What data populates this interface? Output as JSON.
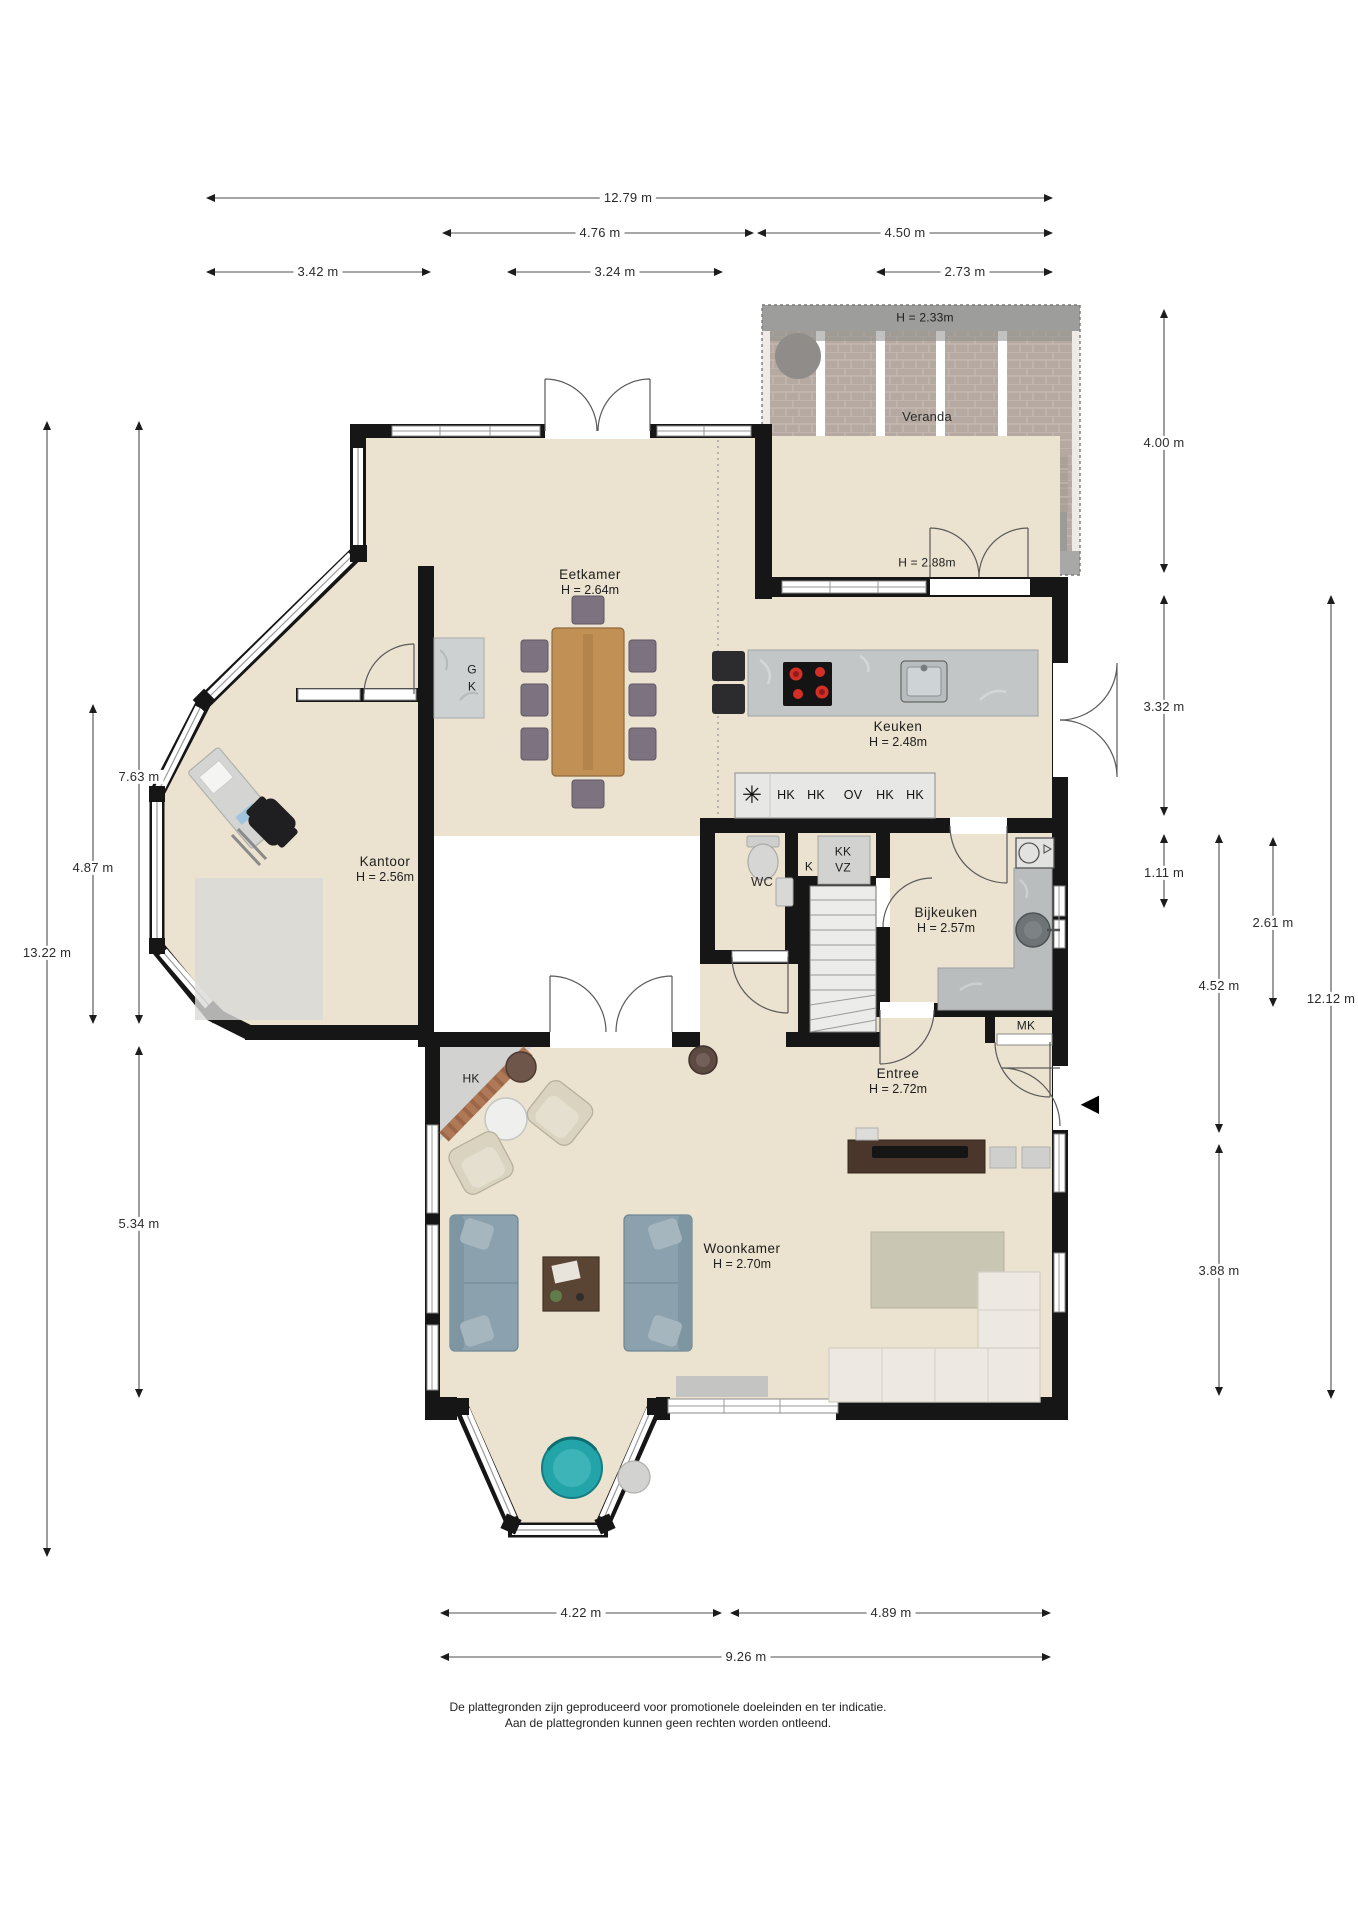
{
  "veranda": {
    "label": "Veranda",
    "height_top": "H = 2.33m",
    "height_bottom": "H = 2.88m"
  },
  "rooms": {
    "eetkamer": {
      "name": "Eetkamer",
      "height": "H = 2.64m"
    },
    "keuken": {
      "name": "Keuken",
      "height": "H = 2.48m"
    },
    "kantoor": {
      "name": "Kantoor",
      "height": "H = 2.56m"
    },
    "wc": {
      "name": "WC"
    },
    "bijkeuken": {
      "name": "Bijkeuken",
      "height": "H = 2.57m"
    },
    "entree": {
      "name": "Entree",
      "height": "H = 2.72m"
    },
    "woonkamer": {
      "name": "Woonkamer",
      "height": "H = 2.70m"
    }
  },
  "labels": {
    "g": "G",
    "k_fireplace": "K",
    "hk_corner": "HK",
    "k_closet": "K",
    "kk": "KK",
    "vz": "VZ",
    "mk": "MK"
  },
  "appliances": {
    "items": [
      "HK",
      "HK",
      "OV",
      "HK",
      "HK"
    ]
  },
  "icons": {
    "extractor_fan": "✳",
    "entrance_arrow": "◀"
  },
  "dimensions": {
    "top": [
      "12.79 m",
      "4.76 m",
      "4.50 m",
      "3.42 m",
      "3.24 m",
      "2.73 m"
    ],
    "left": [
      "13.22 m",
      "7.63 m",
      "4.87 m",
      "5.34 m"
    ],
    "right": [
      "4.00 m",
      "3.32 m",
      "1.11 m",
      "4.52 m",
      "3.88 m",
      "2.61 m",
      "12.12 m"
    ],
    "bottom": [
      "4.22 m",
      "4.89 m",
      "9.26 m"
    ]
  },
  "footer": {
    "line1": "De plattegronden zijn geproduceerd voor promotionele doeleinden en ter indicatie.",
    "line2": "Aan de plattegronden kunnen geen rechten worden ontleend."
  },
  "colors": {
    "floor": "#ebe2cf",
    "wall": "#161616",
    "counter_marble": "#c2c6c7",
    "burner_red": "#d32f27",
    "sofa_blue": "#8ba1ad",
    "chair_purple": "#7d7380",
    "wood_table": "#c09055",
    "turquoise_chair": "#23a4a8",
    "brick_veranda": "#b5a9a1",
    "dimension_line": "#4d4d4d"
  }
}
